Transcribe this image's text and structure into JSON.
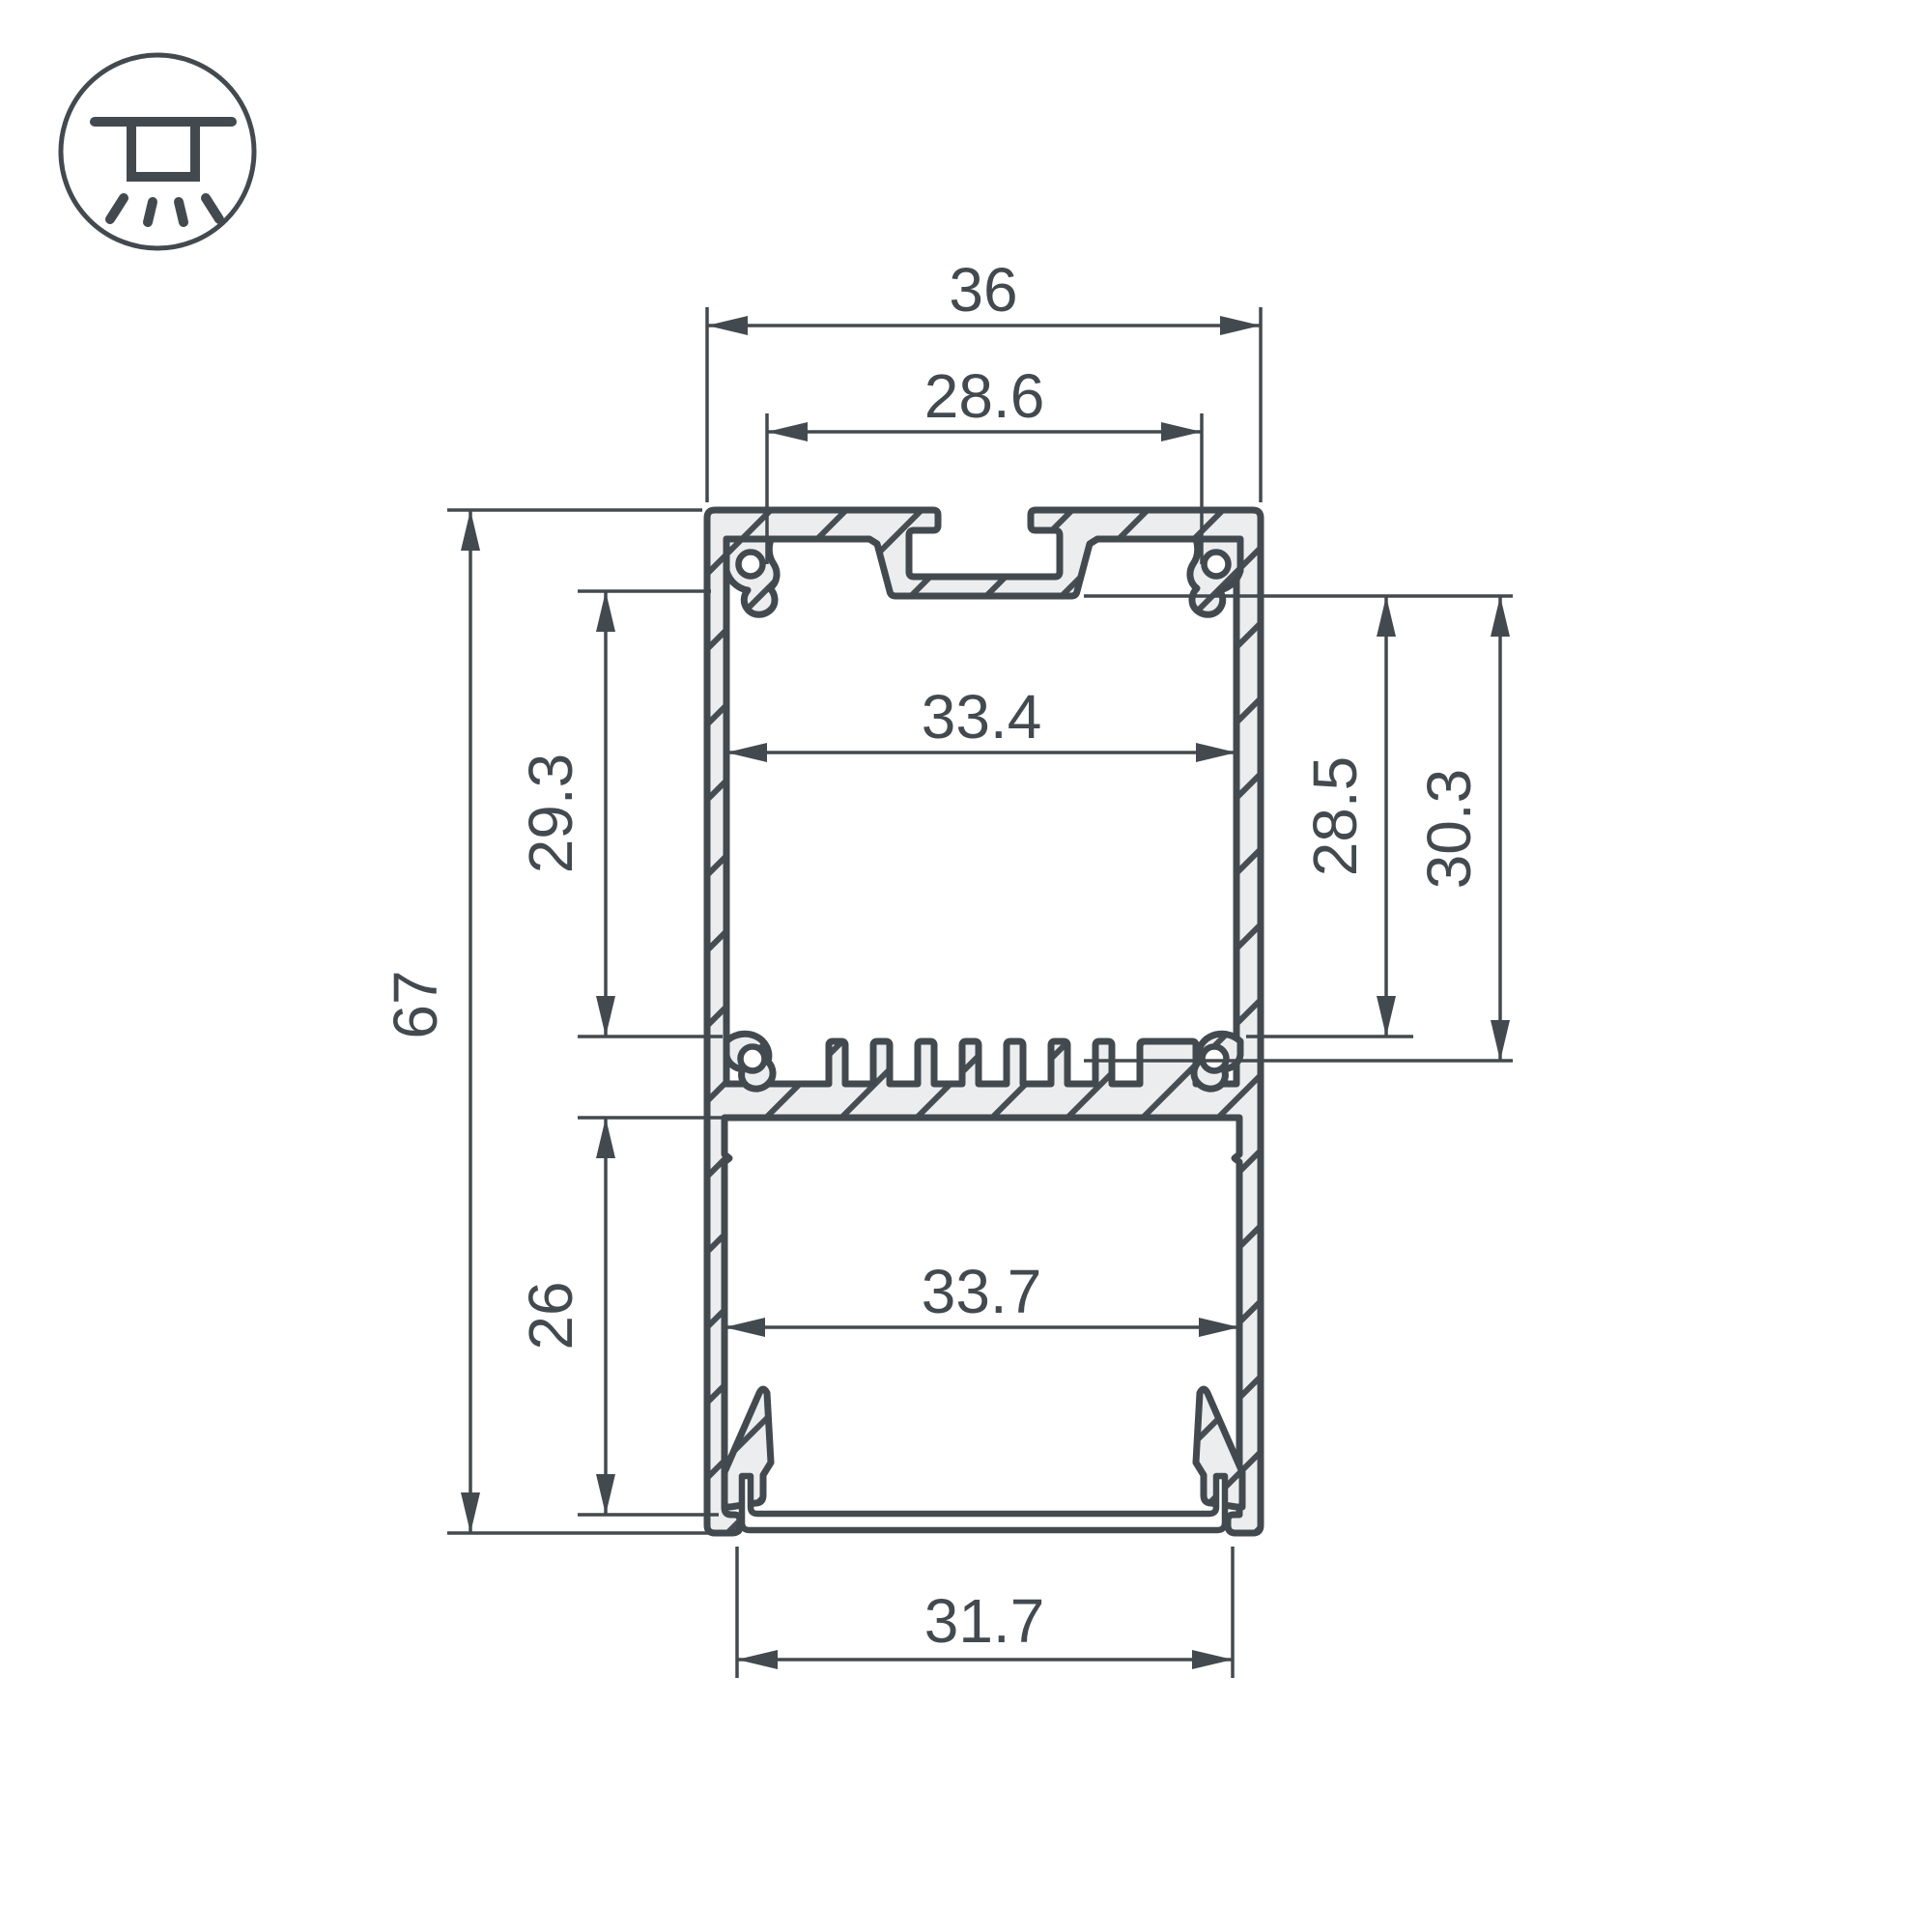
{
  "icons": {
    "mount_type": "ceiling-surface-light-icon"
  },
  "dimensions": {
    "top_width": "36",
    "top_slot_spacing": "28.6",
    "upper_inner_width": "33.4",
    "upper_cavity_height": "29.3",
    "total_height": "67",
    "right_depth_inner": "28.5",
    "right_depth_outer": "30.3",
    "lower_inner_width": "33.7",
    "lower_cavity_height": "26",
    "bottom_opening_width": "31.7"
  },
  "colors": {
    "line": "#434a4f",
    "hatch_fill": "#ecedee",
    "background": "#ffffff"
  }
}
